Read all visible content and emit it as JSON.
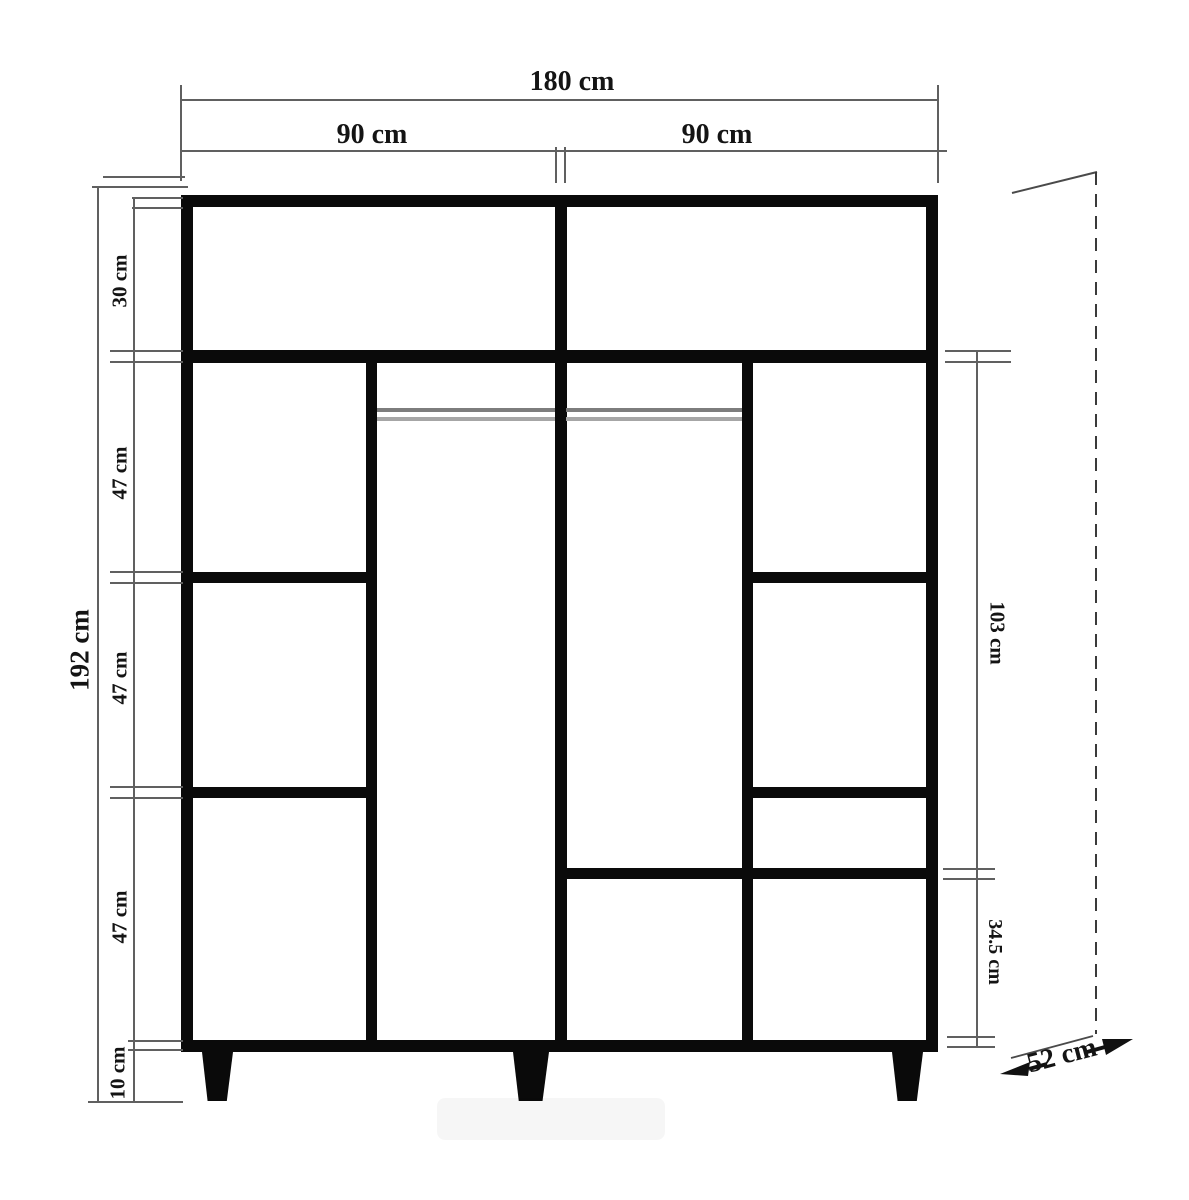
{
  "labels": {
    "total_width": "180 cm",
    "left_section_width": "90 cm",
    "right_section_width": "90 cm",
    "total_height": "192 cm",
    "top_compartment_height": "30 cm",
    "shelf_section_1": "47 cm",
    "shelf_section_2": "47 cm",
    "shelf_section_3": "47 cm",
    "leg_height": "10 cm",
    "hanging_area_height": "103 cm",
    "lower_right_height": "34.5 cm",
    "depth": "52 cm"
  },
  "colors": {
    "structure": "#0a0a0a",
    "dimension_lines": "#606060",
    "rod": "#7d7d7d"
  }
}
